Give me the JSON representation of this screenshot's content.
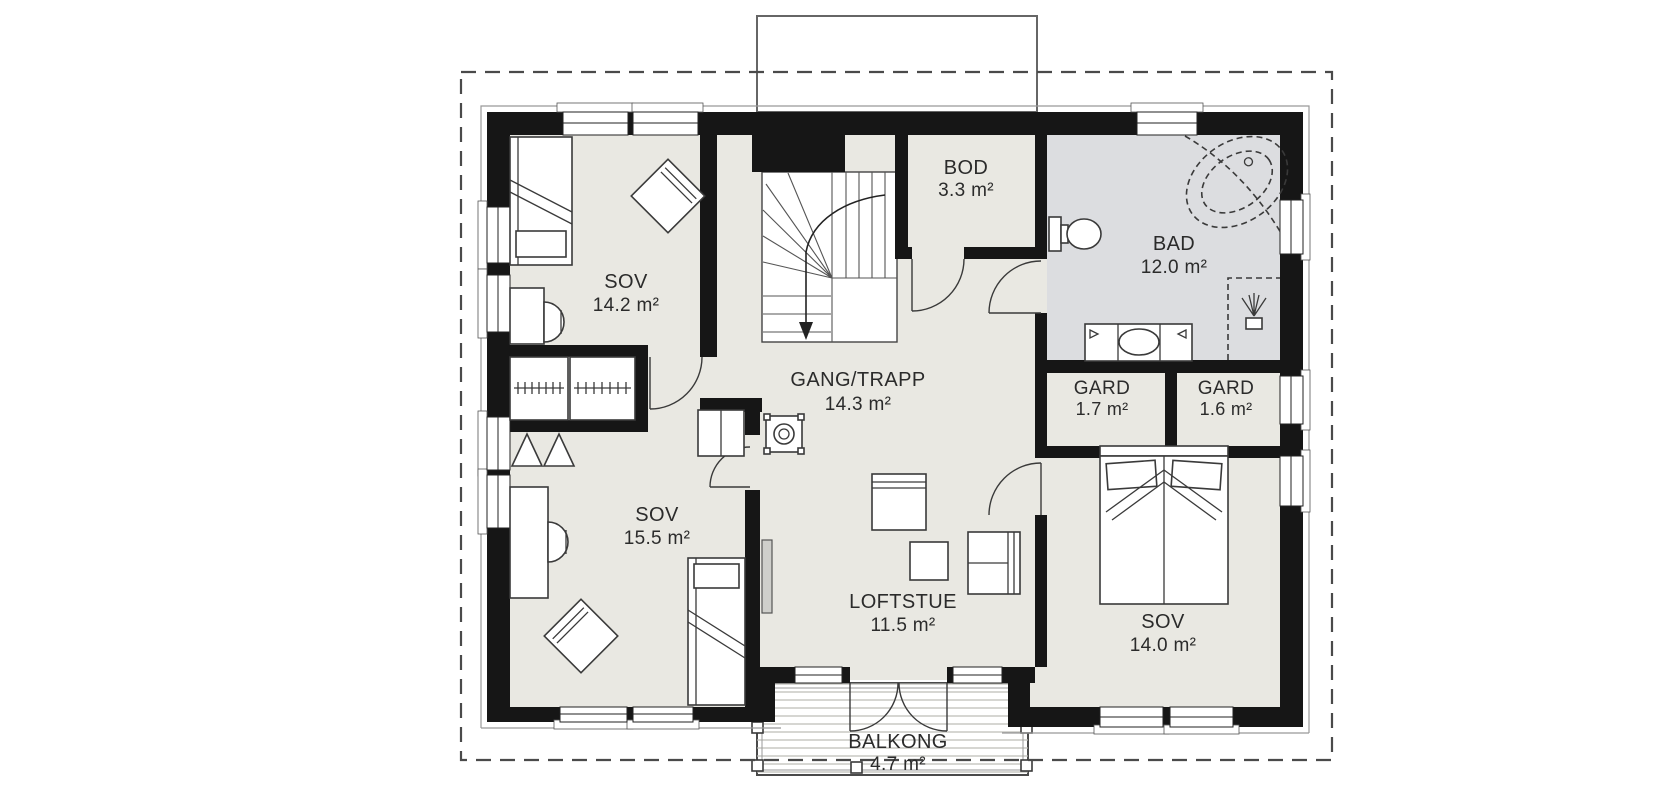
{
  "plan": {
    "rooms": [
      {
        "id": "sov-1",
        "name": "SOV",
        "area": "14.2 m²"
      },
      {
        "id": "sov-2",
        "name": "SOV",
        "area": "15.5 m²"
      },
      {
        "id": "gang-trapp",
        "name": "GANG/TRAPP",
        "area": "14.3 m²"
      },
      {
        "id": "bod",
        "name": "BOD",
        "area": "3.3 m²"
      },
      {
        "id": "bad",
        "name": "BAD",
        "area": "12.0 m²"
      },
      {
        "id": "gard-1",
        "name": "GARD",
        "area": "1.7 m²"
      },
      {
        "id": "gard-2",
        "name": "GARD",
        "area": "1.6 m²"
      },
      {
        "id": "sov-3",
        "name": "SOV",
        "area": "14.0 m²"
      },
      {
        "id": "loftstue",
        "name": "LOFTSTUE",
        "area": "11.5 m²"
      },
      {
        "id": "balkong",
        "name": "BALKONG",
        "area": "4.7 m²"
      }
    ],
    "colors": {
      "wall": "#161616",
      "floor": "#e9e8e2",
      "bathroom_floor": "#dcdde0",
      "deck_line": "#b9b9b4",
      "text": "#2b2b2b"
    }
  }
}
